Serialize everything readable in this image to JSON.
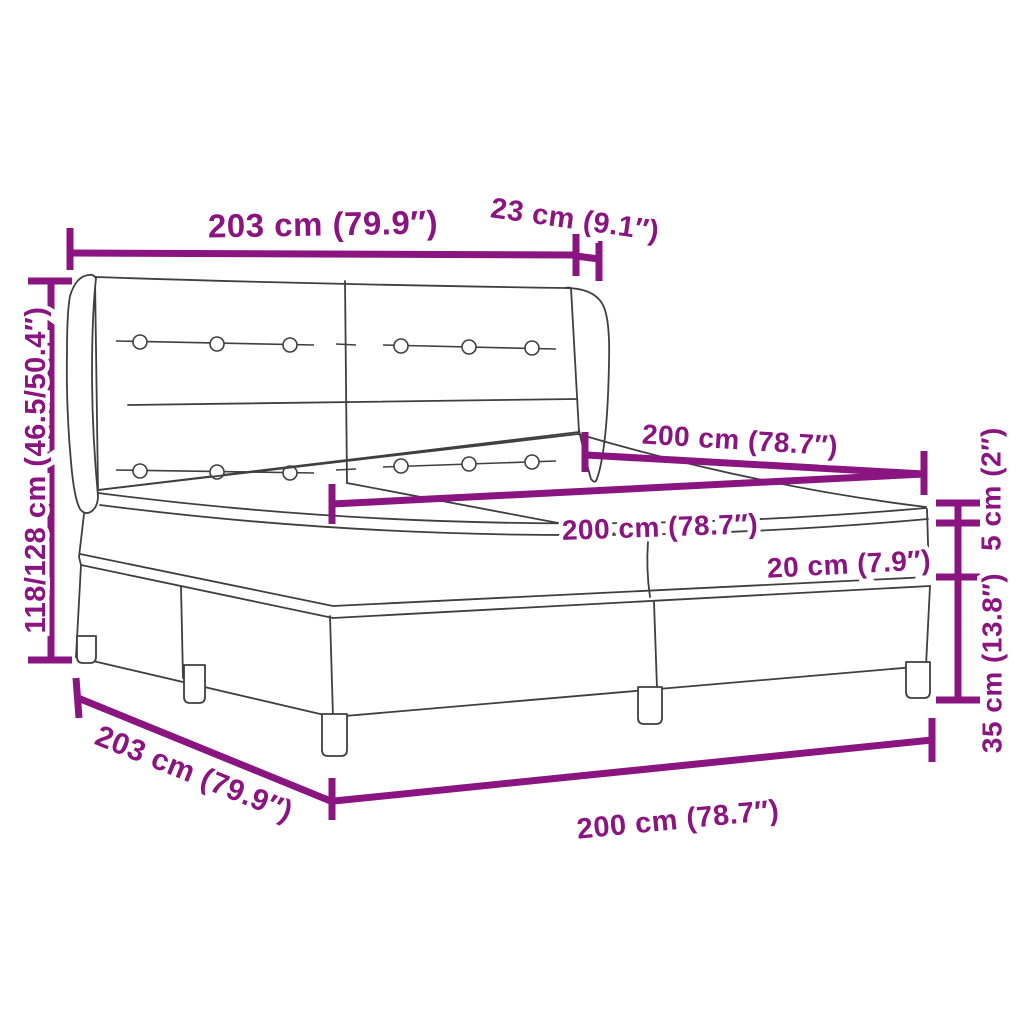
{
  "colors": {
    "accent": "#8a1480",
    "line_art": "#3f3f3f",
    "background": "#ffffff"
  },
  "dimensions": {
    "headboard_width": "203 cm (79.9″)",
    "wing_depth": "23 cm (9.1″)",
    "headboard_height": "118/128 cm (46.5/50.4″)",
    "bed_length": "200 cm (78.7″)",
    "mattress_width": "200 cm (78.7″)",
    "mattress_height": "20 cm (7.9″)",
    "topper_height": "5 cm (2″)",
    "base_height": "35 cm (13.8″)",
    "side_length": "203 cm (79.9″)",
    "bed_width": "200 cm (78.7″)"
  }
}
